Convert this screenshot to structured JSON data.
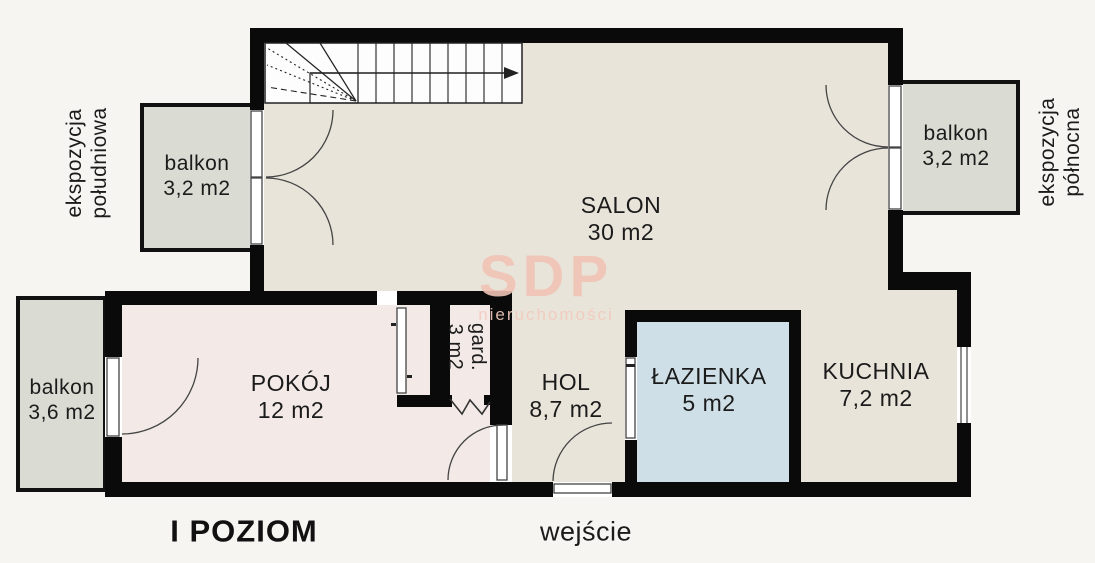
{
  "floor_plan": {
    "title": "I POZIOM",
    "entrance": "wejście",
    "watermark": {
      "brand": "SDP",
      "subtitle": "nieruchomości"
    },
    "rooms": {
      "salon": {
        "name": "SALON",
        "area": "30 m2"
      },
      "pokoj": {
        "name": "POKÓJ",
        "area": "12 m2"
      },
      "hol": {
        "name": "HOL",
        "area": "8,7 m2"
      },
      "lazienka": {
        "name": "ŁAZIENKA",
        "area": "5 m2"
      },
      "kuchnia": {
        "name": "KUCHNIA",
        "area": "7,2 m2"
      },
      "garderoba": {
        "name": "gard.",
        "area": "3 m2"
      }
    },
    "balconies": {
      "south": {
        "name": "balkon",
        "area": "3,2 m2"
      },
      "north": {
        "name": "balkon",
        "area": "3,2 m2"
      },
      "west": {
        "name": "balkon",
        "area": "3,6 m2"
      }
    },
    "exposures": {
      "south": {
        "line1": "ekspozycja",
        "line2": "południowa"
      },
      "north": {
        "line1": "ekspozycja",
        "line2": "północna"
      }
    },
    "colors": {
      "wall": "#0a0a0a",
      "floor_main": "#e8e4da",
      "floor_bedroom": "#f3eae8",
      "floor_bathroom": "#cfdfe7",
      "balcony": "#dadbd3",
      "background": "#f6f5f1",
      "watermark": "#f0c3b5"
    }
  }
}
